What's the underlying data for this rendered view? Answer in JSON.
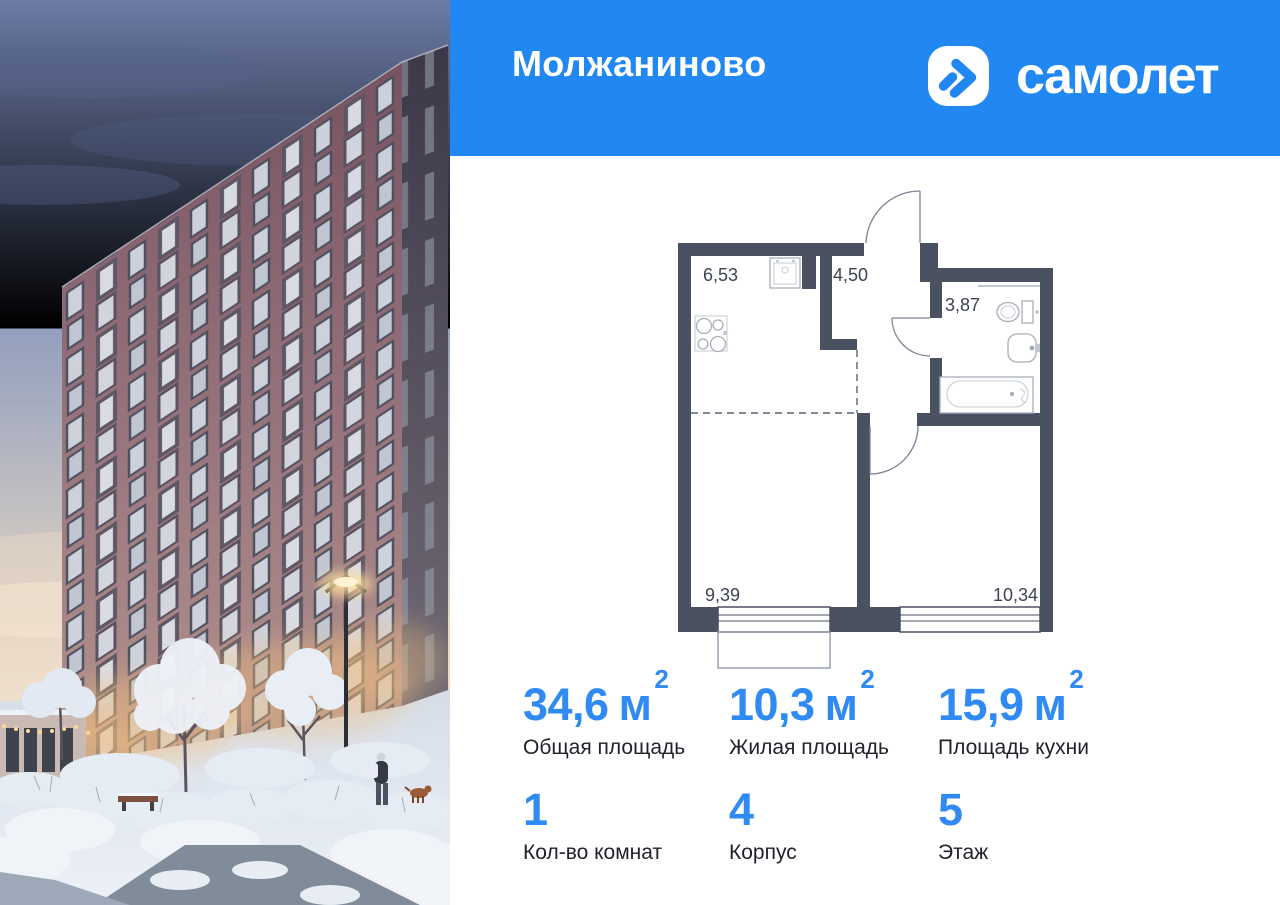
{
  "header": {
    "project_title": "Молжаниново",
    "brand": {
      "wordmark": "самолет",
      "icon": "samolet-arrow-icon"
    }
  },
  "colors": {
    "brand_blue": "#2187F2",
    "accent_blue": "#2F8AF3",
    "wall": "#4A5161",
    "ink": "#20232B",
    "plan_ink": "#3D4352"
  },
  "floorplan": {
    "room_areas": {
      "kitchen_niche": "6,53",
      "hallway": "4,50",
      "bathroom": "3,87",
      "living_zone": "9,39",
      "room": "10,34"
    }
  },
  "stats": {
    "areas": [
      {
        "value": "34,6",
        "unit": "м",
        "sup": "2",
        "label": "Общая площадь"
      },
      {
        "value": "10,3",
        "unit": "м",
        "sup": "2",
        "label": "Жилая площадь"
      },
      {
        "value": "15,9",
        "unit": "м",
        "sup": "2",
        "label": "Площадь кухни"
      }
    ],
    "attributes": [
      {
        "value": "1",
        "label": "Кол-во комнат"
      },
      {
        "value": "4",
        "label": "Корпус"
      },
      {
        "value": "5",
        "label": "Этаж"
      }
    ]
  }
}
